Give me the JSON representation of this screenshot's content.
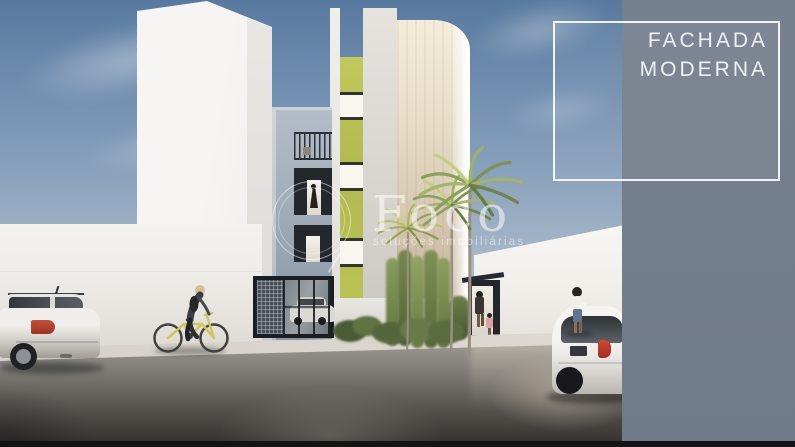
{
  "banner": {
    "title_line1": "FACHADA",
    "title_line2": "MODERNA",
    "panel_color": "#76818F",
    "border_color": "#FFFFFF",
    "text_color": "#EEF1F4"
  },
  "watermark": {
    "brand": "Foco",
    "tagline": "soluções imobiliárias",
    "color": "rgba(255,255,255,0.55)"
  },
  "scene": {
    "description": "3D architectural rendering of a modern multi-story residential building facade seen from the street",
    "palette": {
      "sky_top": "#58799F",
      "sky_horizon": "#E4E5E2",
      "accent_green": "#B5BD52",
      "facade_white": "#E6E3DD",
      "facade_beige": "#D9CCB8",
      "wing_blue_gray": "#A2AEBA",
      "sidewalk": "#D7D3CC",
      "street_dark": "#3A3734",
      "bottom_strip": "#141414"
    },
    "elements": [
      "tall white neighbor building (left)",
      "white boundary wall",
      "blue-gray wing with balcony railing and lit doorways",
      "garage gate with mesh panel and white sedan inside",
      "lime-green accent stripe with three windows",
      "white central tower",
      "beige rounded tower with fluting",
      "three palm trees and vertical garden",
      "white neighbor wall (right) with dark entrance gate",
      "woman and child at entrance gate",
      "woman walking on street",
      "white hatchback car (right)",
      "silver hatchback car (left)",
      "cyclist on yellow bicycle",
      "wet asphalt street with reflections"
    ]
  }
}
